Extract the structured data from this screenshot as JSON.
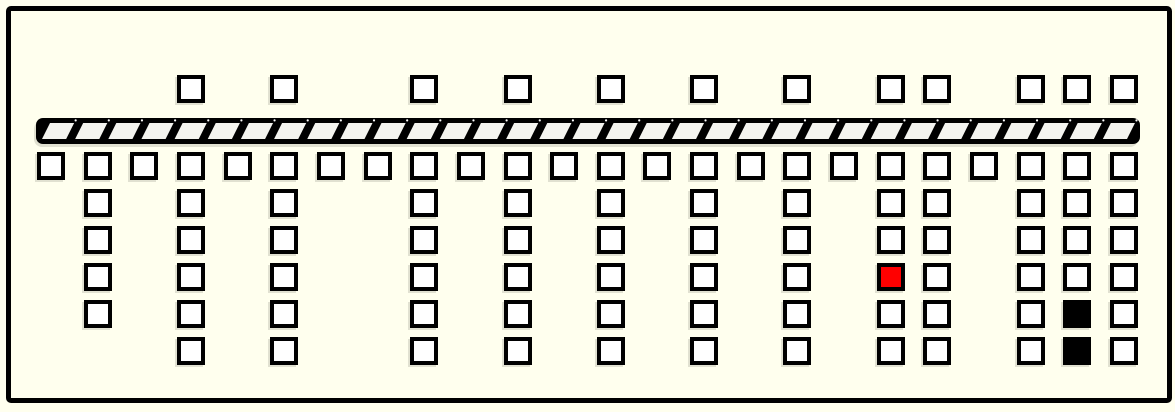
{
  "diagram": {
    "background": "#FFFFEE",
    "frame_color": "#000000",
    "square": {
      "size": 28,
      "border_width": 4,
      "fill": "#FFFFFF",
      "border_color": "#000000"
    },
    "highlight_colors": {
      "red": "#FF0000",
      "black": "#000000"
    },
    "layout": {
      "col_x_start": 37,
      "col_pitch": 46.65,
      "top_row_y": 75,
      "first_row_y": 152,
      "row_pitch": 37,
      "column_count": 24,
      "max_rows_below": 6
    },
    "bar": {
      "x": 36,
      "y": 118,
      "width": 1104,
      "height": 26,
      "cells": 33,
      "slant": 8,
      "cell_fill": "#F4F4EF",
      "frame_fill": "#000000",
      "tick_dot_fill": "#FFFFFF"
    },
    "columns": [
      {
        "col": 1,
        "top_square": false,
        "rows_below": 1
      },
      {
        "col": 2,
        "top_square": false,
        "rows_below": 5
      },
      {
        "col": 3,
        "top_square": false,
        "rows_below": 1
      },
      {
        "col": 4,
        "top_square": true,
        "rows_below": 6
      },
      {
        "col": 5,
        "top_square": false,
        "rows_below": 1
      },
      {
        "col": 6,
        "top_square": true,
        "rows_below": 6
      },
      {
        "col": 7,
        "top_square": false,
        "rows_below": 1
      },
      {
        "col": 8,
        "top_square": false,
        "rows_below": 1
      },
      {
        "col": 9,
        "top_square": true,
        "rows_below": 6
      },
      {
        "col": 10,
        "top_square": false,
        "rows_below": 1
      },
      {
        "col": 11,
        "top_square": true,
        "rows_below": 6
      },
      {
        "col": 12,
        "top_square": false,
        "rows_below": 1
      },
      {
        "col": 13,
        "top_square": true,
        "rows_below": 6
      },
      {
        "col": 14,
        "top_square": false,
        "rows_below": 1
      },
      {
        "col": 15,
        "top_square": true,
        "rows_below": 6
      },
      {
        "col": 16,
        "top_square": false,
        "rows_below": 1
      },
      {
        "col": 17,
        "top_square": true,
        "rows_below": 6
      },
      {
        "col": 18,
        "top_square": false,
        "rows_below": 1
      },
      {
        "col": 19,
        "top_square": true,
        "rows_below": 6,
        "marks": [
          {
            "row": 4,
            "color": "red"
          }
        ]
      },
      {
        "col": 20,
        "top_square": true,
        "rows_below": 6
      },
      {
        "col": 21,
        "top_square": false,
        "rows_below": 1
      },
      {
        "col": 22,
        "top_square": true,
        "rows_below": 6
      },
      {
        "col": 23,
        "top_square": true,
        "rows_below": 6,
        "marks": [
          {
            "row": 5,
            "color": "black"
          },
          {
            "row": 6,
            "color": "black"
          }
        ]
      },
      {
        "col": 24,
        "top_square": true,
        "rows_below": 6
      }
    ]
  }
}
